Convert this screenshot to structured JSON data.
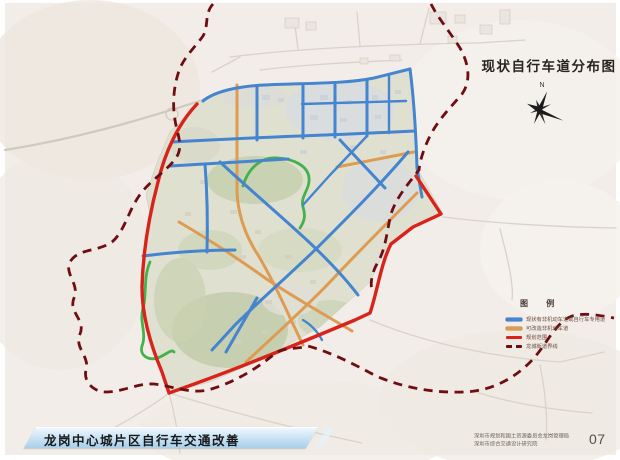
{
  "map_title": "现状自行车道分布图",
  "compass": {
    "label": "N"
  },
  "legend": {
    "title": "图例",
    "title_display": "图 例",
    "items": [
      {
        "label": "现状有非机动车道或自行车专用道",
        "color": "#4584cf",
        "style": "solid"
      },
      {
        "label": "可改造非机动车道",
        "color": "#dd9c52",
        "style": "solid"
      },
      {
        "label": "规划范围",
        "color": "#d8231a",
        "style": "solid"
      },
      {
        "label": "龙城街道界线",
        "color": "#6e0d12",
        "style": "dashed"
      }
    ]
  },
  "footer": {
    "banner_title": "龙岗中心城片区自行车交通改善",
    "credits": [
      "深圳市规划和国土资源委员会龙岗管理局",
      "深圳市综合交通设计研究院"
    ],
    "page_number": "07"
  },
  "colors": {
    "existing_bike_lane": "#4584cf",
    "convertible_lane": "#dd9c52",
    "planning_boundary": "#d8231a",
    "district_boundary": "#6e0d12",
    "greenway": "#44b14b",
    "banner": "#b9d9ee",
    "paper_outside": "#f2ede8",
    "map_inside": "#dfe0d0"
  }
}
